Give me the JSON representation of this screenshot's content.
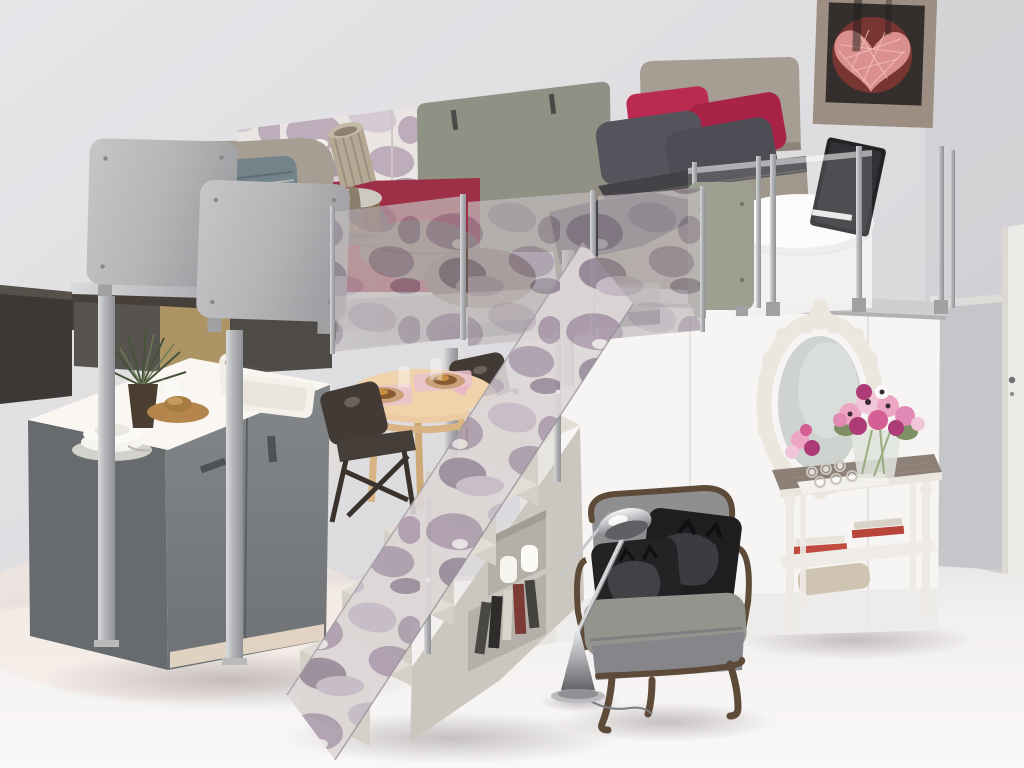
{
  "meta": {
    "type": "photograph",
    "subject": "Tiny studio apartment with loft-bed mezzanine: bed and sofa on a raised platform with camouflage glass railings, kitchen, dining table, storage staircase, wardrobe with baroque mirror, console with pink flowers, grey armchair and chrome floor lamp",
    "width_px": 1024,
    "height_px": 768
  },
  "palette": {
    "wall": "#dfdee1",
    "wallDark": "#cfced2",
    "floor": "#f3f1f1",
    "floorWarm": "#f6e7dd",
    "aluminum": "#b6b8ba",
    "platformFascia": "#47403a",
    "grayPanel": "#b9b9bb",
    "olivePanel": "#8e9184",
    "oliveSide": "#9ba091",
    "camoBase": "#eae4e2",
    "camoPurple": "#b2a0b0",
    "camoLilac": "#d0c4ce",
    "camoDark": "#9a8b9b",
    "headboard": "#a69d93",
    "blanketTaupe": "#92887b",
    "beddingDark": "#424247",
    "pillowDark": "#55535b",
    "pillowMagenta": "#bb2a50",
    "mattress": "#c8bfb0",
    "sofaRed": "#9d3046",
    "pillowTeal": "#7e8e91",
    "cushionBrown": "#6f5c52",
    "kitchenGray": "#7b7f82",
    "kitchenGrayDark": "#686c6f",
    "counter": "#faf7f2",
    "warmGlow": "#f7e3c4",
    "stairsCream": "#e2ded6",
    "stairsFace": "#d4d0c8",
    "stairsSide": "#cbc7bf",
    "cubbyShadow": "#b4b0a8",
    "tableWood": "#eccba3",
    "tableWoodEdge": "#d9b384",
    "chairDark": "#423a34",
    "armchairGray": "#8f8f92",
    "armchairWood": "#5d4a38",
    "cushionBlack": "#1e1e21",
    "consoleWood": "#8d8077",
    "consoleWhite": "#edeae4",
    "mirrorWhite": "#ebe7df",
    "mirrorGlass": "#ced3cf",
    "flowerPink": "#eca6c3",
    "flowerMagenta": "#ac3b76",
    "leafGreen": "#7d8f63",
    "artworkTan": "#a3968b",
    "artworkDark": "#342f2d",
    "heartRed": "#8e3a34",
    "heartWire": "#e49a97",
    "doorWhite": "#eceae7",
    "partitionGray": "#c5c6ca",
    "volumeWhite": "#f6f5f3",
    "plantGreen": "#46523a",
    "chrome": "#c8c9cb"
  },
  "scene": {
    "objects": [
      {
        "name": "wall",
        "label": "light grey wall"
      },
      {
        "name": "floor",
        "label": "white resin floor"
      },
      {
        "name": "heart-artwork",
        "label": "canvas with pink wire heart"
      },
      {
        "name": "door",
        "label": "white door, far right"
      },
      {
        "name": "glass-partition",
        "label": "grey glass partition"
      },
      {
        "name": "loft-platform",
        "label": "aluminium frame mezzanine"
      },
      {
        "name": "bed",
        "label": "double bed with taupe and magenta bedding"
      },
      {
        "name": "loft-desk",
        "label": "white kidney desk with laptop"
      },
      {
        "name": "sofa",
        "label": "red sofa with patterned cushions"
      },
      {
        "name": "table-lamp",
        "label": "rustic lamp on wooden stool"
      },
      {
        "name": "metal-railing-panels",
        "label": "grey metal balustrade panels"
      },
      {
        "name": "camo-glass-panels",
        "label": "camouflage print glass balustrade"
      },
      {
        "name": "kitchen",
        "label": "grey kitchen block with sink"
      },
      {
        "name": "dining-table",
        "label": "round wooden table, set for two"
      },
      {
        "name": "folding-chairs",
        "label": "two dark folding chairs"
      },
      {
        "name": "storage-staircase",
        "label": "cream staircase with cubbies"
      },
      {
        "name": "wardrobe-volume",
        "label": "white wardrobe under bed"
      },
      {
        "name": "baroque-mirror",
        "label": "ornate white oval mirror"
      },
      {
        "name": "console-table",
        "label": "console with flowers, candles, books"
      },
      {
        "name": "armchair",
        "label": "grey Louis armchair with black cat cushions"
      },
      {
        "name": "floor-lamp",
        "label": "chrome arc floor lamp"
      }
    ]
  }
}
